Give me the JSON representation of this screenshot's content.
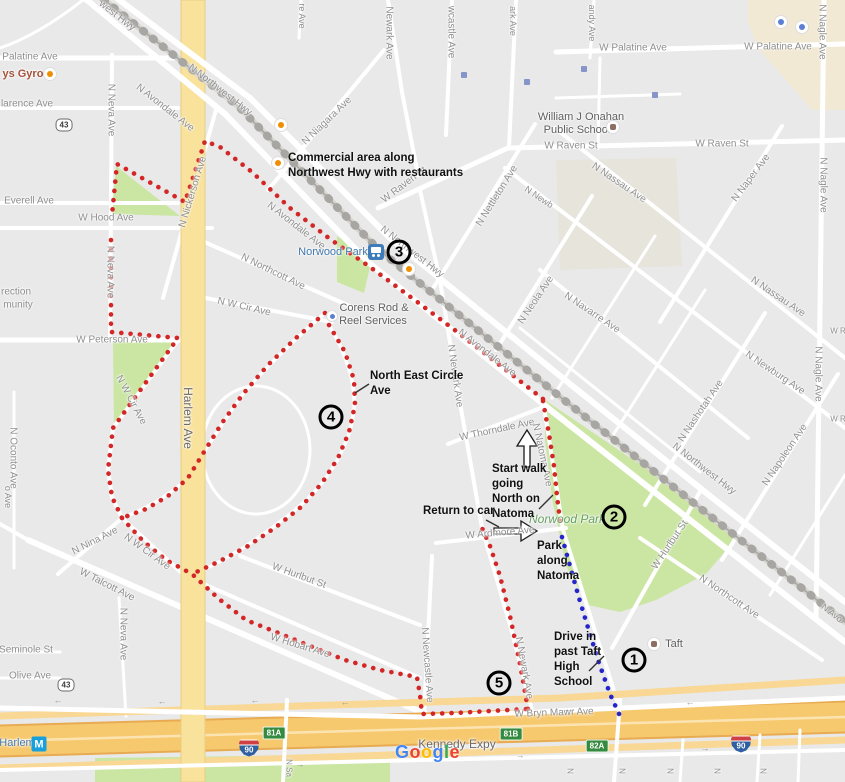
{
  "colors": {
    "walk_route": "#d32727",
    "drive_route": "#2525cb",
    "park_green": "#cbe6a3",
    "expressway_orange": "#f7c96e",
    "harlem_yellow": "#f9e29c",
    "exit_badge_green": "#348a3e"
  },
  "street_labels": [
    {
      "t": "west Hwy",
      "x": 117,
      "y": 16,
      "r": 38
    },
    {
      "t": "Palatine Ave",
      "x": 30,
      "y": 57
    },
    {
      "t": "larence Ave",
      "x": 27,
      "y": 104
    },
    {
      "t": "Everell Ave",
      "x": 29,
      "y": 201
    },
    {
      "t": "W Hood Ave",
      "x": 106,
      "y": 218
    },
    {
      "t": "N Neva Ave",
      "x": 111,
      "y": 110,
      "r": 90
    },
    {
      "t": "N Neva Ave",
      "x": 110,
      "y": 272,
      "r": 90
    },
    {
      "t": "N Neva Ave",
      "x": 123,
      "y": 634,
      "r": 90
    },
    {
      "t": "N Nickerson Ave",
      "x": 193,
      "y": 192,
      "r": -73
    },
    {
      "t": "N Northwest Hwy",
      "x": 220,
      "y": 90,
      "r": 38
    },
    {
      "t": "N Avondale Ave",
      "x": 165,
      "y": 108,
      "r": 38
    },
    {
      "t": "N Northcott Ave",
      "x": 273,
      "y": 272,
      "r": 26
    },
    {
      "t": "N W Cir Ave",
      "x": 244,
      "y": 307,
      "r": 13
    },
    {
      "t": "rection",
      "x": 16,
      "y": 292
    },
    {
      "t": "munity",
      "x": 18,
      "y": 305
    },
    {
      "t": "W Peterson Ave",
      "x": 112,
      "y": 340
    },
    {
      "t": "N W Cir Ave",
      "x": 131,
      "y": 400,
      "r": 62
    },
    {
      "t": "Harlem Ave",
      "x": 188,
      "y": 418,
      "r": 90,
      "s": 12,
      "cls": "dark"
    },
    {
      "t": "N Oconto Ave",
      "x": 13,
      "y": 458,
      "r": 90
    },
    {
      "t": "o Ave",
      "x": 8,
      "y": 497,
      "r": 90,
      "s": 9
    },
    {
      "t": "N Nina Ave",
      "x": 95,
      "y": 541,
      "r": -27
    },
    {
      "t": "N W Cir Ave",
      "x": 147,
      "y": 552,
      "r": 36
    },
    {
      "t": "W Talcott Ave",
      "x": 107,
      "y": 585,
      "r": 27
    },
    {
      "t": "Seminole St",
      "x": 26,
      "y": 650
    },
    {
      "t": "Olive Ave",
      "x": 30,
      "y": 676
    },
    {
      "t": "N Niagara Ave",
      "x": 327,
      "y": 121,
      "r": -44
    },
    {
      "t": "re Ave",
      "x": 302,
      "y": 16,
      "r": 90,
      "s": 9
    },
    {
      "t": "Newark Ave",
      "x": 389,
      "y": 33,
      "r": 90
    },
    {
      "t": "wcastle Ave",
      "x": 451,
      "y": 32,
      "r": 90
    },
    {
      "t": "ark Ave",
      "x": 513,
      "y": 21,
      "r": 90,
      "s": 9
    },
    {
      "t": "andy Ave",
      "x": 592,
      "y": 23,
      "r": 90,
      "s": 9
    },
    {
      "t": "W Palatine Ave",
      "x": 633,
      "y": 48
    },
    {
      "t": "W Palatine Ave",
      "x": 778,
      "y": 47
    },
    {
      "t": "W Raven St",
      "x": 571,
      "y": 146
    },
    {
      "t": "W Raven St",
      "x": 722,
      "y": 144
    },
    {
      "t": "W Raven St",
      "x": 404,
      "y": 185,
      "r": -37
    },
    {
      "t": "N Nettleton Ave",
      "x": 497,
      "y": 196,
      "r": -58
    },
    {
      "t": "N Newb",
      "x": 539,
      "y": 197,
      "r": 34,
      "s": 9
    },
    {
      "t": "N Nassau Ave",
      "x": 619,
      "y": 183,
      "r": 34
    },
    {
      "t": "N Nassau Ave",
      "x": 778,
      "y": 297,
      "r": 34
    },
    {
      "t": "N Naper Ave",
      "x": 751,
      "y": 178,
      "r": -53
    },
    {
      "t": "N Nagle Ave",
      "x": 822,
      "y": 32,
      "r": 90
    },
    {
      "t": "N Nagle Ave",
      "x": 823,
      "y": 185,
      "r": 90
    },
    {
      "t": "N Nagle Ave",
      "x": 818,
      "y": 374,
      "r": 90
    },
    {
      "t": "N Newburg Ave",
      "x": 775,
      "y": 373,
      "r": 34
    },
    {
      "t": "N Navarre Ave",
      "x": 592,
      "y": 313,
      "r": 34
    },
    {
      "t": "N Neola Ave",
      "x": 536,
      "y": 300,
      "r": -56
    },
    {
      "t": "N Northwest Hwy",
      "x": 412,
      "y": 252,
      "r": 38
    },
    {
      "t": "N Avondale Ave",
      "x": 296,
      "y": 226,
      "r": 38
    },
    {
      "t": "N Newark Ave",
      "x": 455,
      "y": 376,
      "r": 82
    },
    {
      "t": "N Avondale Ave",
      "x": 487,
      "y": 353,
      "r": 38
    },
    {
      "t": "N Northwest Hwy",
      "x": 704,
      "y": 469,
      "r": 38
    },
    {
      "t": "W Thorndale Ave",
      "x": 497,
      "y": 430,
      "r": -12
    },
    {
      "t": "N Natoma Ave",
      "x": 542,
      "y": 455,
      "r": 78
    },
    {
      "t": "W Ardmore Ave",
      "x": 500,
      "y": 533,
      "r": -5
    },
    {
      "t": "W Hurlbut St",
      "x": 670,
      "y": 545,
      "r": -56
    },
    {
      "t": "N Northcott Ave",
      "x": 729,
      "y": 597,
      "r": 34
    },
    {
      "t": "W Hurlbut St",
      "x": 299,
      "y": 576,
      "r": 20
    },
    {
      "t": "W Hobart Ave",
      "x": 300,
      "y": 646,
      "r": 17
    },
    {
      "t": "N Newcastle Ave",
      "x": 427,
      "y": 665,
      "r": 86
    },
    {
      "t": "N Newark Ave",
      "x": 524,
      "y": 668,
      "r": 80
    },
    {
      "t": "W Bryn Mawr Ave",
      "x": 554,
      "y": 713,
      "r": -2
    },
    {
      "t": "N Nashotah Ave",
      "x": 701,
      "y": 411,
      "r": -56
    },
    {
      "t": "N Napoleon Ave",
      "x": 785,
      "y": 455,
      "r": -56
    },
    {
      "t": "N Avo",
      "x": 832,
      "y": 613,
      "r": 38,
      "s": 9
    },
    {
      "t": "W R",
      "x": 838,
      "y": 331,
      "s": 8
    },
    {
      "t": "W R",
      "x": 838,
      "y": 419,
      "s": 8
    },
    {
      "t": "N Sa",
      "x": 289,
      "y": 768,
      "r": 90,
      "s": 8
    },
    {
      "t": "N",
      "x": 570,
      "y": 771,
      "r": 90,
      "s": 8
    },
    {
      "t": "N",
      "x": 622,
      "y": 771,
      "r": 90,
      "s": 8
    },
    {
      "t": "N",
      "x": 670,
      "y": 771,
      "r": 90,
      "s": 8
    },
    {
      "t": "N",
      "x": 717,
      "y": 771,
      "r": 90,
      "s": 8
    },
    {
      "t": "N",
      "x": 763,
      "y": 771,
      "r": 90,
      "s": 8
    },
    {
      "t": "Kennedy Expy",
      "x": 457,
      "y": 744,
      "s": 12,
      "cls": "dark"
    }
  ],
  "poi_labels": [
    {
      "t": "ys Gyros",
      "x": 26,
      "y": 74,
      "cls": "poi-red",
      "s": 11
    },
    {
      "t": "William J Onahan",
      "x": 581,
      "y": 117,
      "cls": "poi-dark",
      "s": 11
    },
    {
      "t": "Public School",
      "x": 577,
      "y": 130,
      "cls": "poi-dark",
      "s": 11
    },
    {
      "t": "Norwood Park",
      "x": 333,
      "y": 252,
      "cls": "poi-blue",
      "s": 11
    },
    {
      "t": "Corens Rod &",
      "x": 374,
      "y": 308,
      "cls": "poi-dark",
      "s": 11
    },
    {
      "t": "Reel Services",
      "x": 373,
      "y": 321,
      "cls": "poi-dark",
      "s": 11
    },
    {
      "t": "Norwood Park",
      "x": 567,
      "y": 519,
      "cls": "poi-park",
      "s": 12
    },
    {
      "t": "Taft",
      "x": 674,
      "y": 644,
      "cls": "poi-dark",
      "s": 11
    },
    {
      "t": "Harlem",
      "x": 17,
      "y": 743,
      "cls": "poi-blue",
      "s": 11
    }
  ],
  "road_arrows": [
    {
      "t": "←",
      "x": 58,
      "y": 700
    },
    {
      "t": "←",
      "x": 162,
      "y": 701
    },
    {
      "t": "←",
      "x": 255,
      "y": 700
    },
    {
      "t": "←",
      "x": 345,
      "y": 702
    },
    {
      "t": "←",
      "x": 568,
      "y": 709
    },
    {
      "t": "←",
      "x": 690,
      "y": 702
    },
    {
      "t": "→",
      "x": 300,
      "y": 764
    },
    {
      "t": "→",
      "x": 520,
      "y": 755
    },
    {
      "t": "→",
      "x": 705,
      "y": 748
    }
  ],
  "annotations": [
    {
      "id": "commercial-area-note",
      "x": 288,
      "y": 151,
      "lines": [
        "Commercial area along",
        "Northwest Hwy with restaurants"
      ]
    },
    {
      "id": "ne-circle-note",
      "x": 370,
      "y": 369,
      "lines": [
        "North East Circle",
        "Ave"
      ]
    },
    {
      "id": "start-walk-note",
      "x": 492,
      "y": 462,
      "lines": [
        "Start walk",
        "going",
        "North on",
        "Natoma"
      ]
    },
    {
      "id": "return-to-car-note",
      "x": 423,
      "y": 504,
      "lines": [
        "Return to car"
      ]
    },
    {
      "id": "park-along-note",
      "x": 537,
      "y": 539,
      "lines": [
        "Park",
        "along",
        "Natoma"
      ]
    },
    {
      "id": "drive-in-note",
      "x": 554,
      "y": 630,
      "lines": [
        "Drive in",
        "past Taft",
        "High",
        "School"
      ]
    }
  ],
  "waypoints": [
    {
      "n": "1",
      "x": 634,
      "y": 660
    },
    {
      "n": "2",
      "x": 614,
      "y": 517
    },
    {
      "n": "3",
      "x": 399,
      "y": 252
    },
    {
      "n": "4",
      "x": 331,
      "y": 417
    },
    {
      "n": "5",
      "x": 499,
      "y": 683
    }
  ],
  "routes": {
    "walk": {
      "color": "#d32727",
      "segments": [
        [
          [
            543,
            399
          ],
          [
            456,
            331
          ],
          [
            412,
            298
          ],
          [
            370,
            267
          ],
          [
            330,
            239
          ],
          [
            290,
            208
          ],
          [
            252,
            172
          ],
          [
            220,
            147
          ],
          [
            205,
            141
          ],
          [
            185,
            202
          ],
          [
            117,
            164
          ],
          [
            112,
            215
          ]
        ],
        [
          [
            111,
            240
          ],
          [
            111,
            332
          ],
          [
            178,
            338
          ],
          [
            113,
            428
          ],
          [
            108,
            470
          ],
          [
            112,
            497
          ],
          [
            122,
            518
          ]
        ],
        [
          [
            325,
            313
          ],
          [
            296,
            338
          ],
          [
            268,
            365
          ],
          [
            243,
            394
          ],
          [
            222,
            423
          ],
          [
            204,
            452
          ],
          [
            188,
            478
          ],
          [
            168,
            496
          ],
          [
            146,
            509
          ],
          [
            122,
            518
          ]
        ],
        [
          [
            329,
            325
          ],
          [
            345,
            352
          ],
          [
            354,
            380
          ],
          [
            355,
            405
          ],
          [
            349,
            432
          ],
          [
            338,
            458
          ],
          [
            322,
            483
          ],
          [
            301,
            507
          ],
          [
            276,
            527
          ],
          [
            248,
            546
          ],
          [
            218,
            562
          ],
          [
            192,
            574
          ]
        ],
        [
          [
            122,
            518
          ],
          [
            143,
            541
          ],
          [
            166,
            560
          ],
          [
            192,
            574
          ],
          [
            219,
            599
          ],
          [
            246,
            620
          ],
          [
            276,
            632
          ],
          [
            310,
            646
          ],
          [
            345,
            660
          ],
          [
            380,
            670
          ],
          [
            417,
            677
          ],
          [
            420,
            695
          ],
          [
            422,
            714
          ],
          [
            455,
            713
          ],
          [
            490,
            711
          ],
          [
            528,
            709
          ]
        ],
        [
          [
            528,
            709
          ],
          [
            520,
            664
          ],
          [
            510,
            616
          ],
          [
            500,
            576
          ],
          [
            490,
            546
          ],
          [
            482,
            528
          ]
        ],
        [
          [
            543,
            401
          ],
          [
            549,
            434
          ],
          [
            554,
            466
          ],
          [
            557,
            496
          ],
          [
            561,
            528
          ]
        ]
      ]
    },
    "drive": {
      "color": "#2525cb",
      "segments": [
        [
          [
            562,
            537
          ],
          [
            570,
            566
          ],
          [
            579,
            598
          ],
          [
            589,
            631
          ],
          [
            599,
            663
          ],
          [
            610,
            694
          ],
          [
            620,
            716
          ]
        ]
      ]
    }
  },
  "badges": {
    "exits": [
      {
        "t": "81A",
        "x": 274,
        "y": 733
      },
      {
        "t": "81B",
        "x": 511,
        "y": 734
      },
      {
        "t": "82A",
        "x": 597,
        "y": 746
      }
    ],
    "interstate": [
      {
        "t": "90",
        "x": 249,
        "y": 748
      },
      {
        "t": "90",
        "x": 741,
        "y": 744
      }
    ],
    "state_route": [
      {
        "t": "43",
        "x": 64,
        "y": 125
      },
      {
        "t": "43",
        "x": 66,
        "y": 685
      }
    ],
    "metro": {
      "t": "M",
      "x": 39,
      "y": 744
    }
  },
  "icons": [
    {
      "k": "restaurant",
      "x": 50,
      "y": 74
    },
    {
      "k": "bar",
      "x": 281,
      "y": 125
    },
    {
      "k": "restaurant",
      "x": 278,
      "y": 163
    },
    {
      "k": "restaurant",
      "x": 409,
      "y": 269
    },
    {
      "k": "lodging",
      "x": 332,
      "y": 316
    },
    {
      "k": "train-station",
      "x": 376,
      "y": 252
    },
    {
      "k": "school",
      "x": 613,
      "y": 127
    },
    {
      "k": "school",
      "x": 654,
      "y": 644
    },
    {
      "k": "shopping-cart",
      "x": 781,
      "y": 22
    },
    {
      "k": "shopping-bag",
      "x": 802,
      "y": 27
    },
    {
      "k": "transit-stop",
      "x": 464,
      "y": 75
    },
    {
      "k": "transit-stop",
      "x": 527,
      "y": 82
    },
    {
      "k": "transit-stop",
      "x": 584,
      "y": 69
    },
    {
      "k": "transit-stop",
      "x": 655,
      "y": 95
    }
  ],
  "watermark": {
    "text": "Google",
    "letters": [
      {
        "ch": "G",
        "color": "#4285F4"
      },
      {
        "ch": "o",
        "color": "#EA4335"
      },
      {
        "ch": "o",
        "color": "#FBBC05"
      },
      {
        "ch": "g",
        "color": "#4285F4"
      },
      {
        "ch": "l",
        "color": "#34A853"
      },
      {
        "ch": "e",
        "color": "#EA4335"
      }
    ]
  }
}
